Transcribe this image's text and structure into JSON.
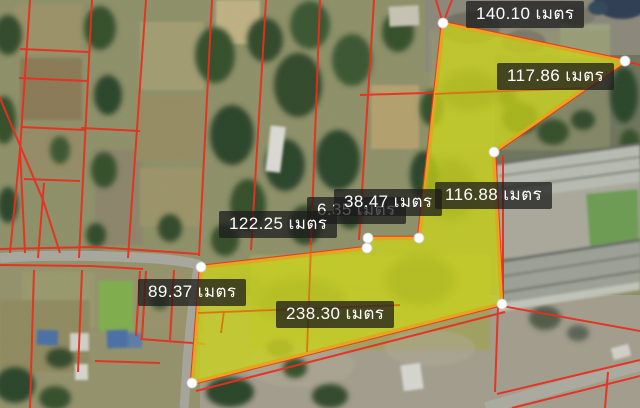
{
  "app": {
    "type": "satellite-map-land-measurement-tool",
    "language": "th",
    "unit_label": "เมตร"
  },
  "colors": {
    "parcel_fill": "#cbd318",
    "parcel_stroke": "#f0a01c",
    "cadastral_line": "#e92c1c",
    "vertex_handle": "#ffffff",
    "label_background": "rgba(28,28,28,0.75)",
    "label_text": "#ffffff"
  },
  "map": {
    "view": "satellite",
    "overlay": "cadastral-parcel-boundaries",
    "parcel": {
      "fill_color": "#cbd318",
      "stroke_color": "#f0a01c",
      "points": [
        [
          443,
          23
        ],
        [
          625,
          61
        ],
        [
          494,
          152
        ],
        [
          502,
          304
        ],
        [
          192,
          383
        ],
        [
          201,
          267
        ],
        [
          367,
          248
        ],
        [
          368,
          238
        ],
        [
          419,
          238
        ]
      ]
    },
    "measurements": [
      {
        "value": "140.10",
        "unit": "เมตร",
        "text": "140.10 เมตร"
      },
      {
        "value": "117.86",
        "unit": "เมตร",
        "text": "117.86 เมตร"
      },
      {
        "value": "116.88",
        "unit": "เมตร",
        "text": "116.88 เมตร"
      },
      {
        "value": "38.47",
        "unit": "เมตร",
        "text": "38.47 เมตร"
      },
      {
        "value": "6.35",
        "unit": "เมตร",
        "text": "6.35 เมตร"
      },
      {
        "value": "122.25",
        "unit": "เมตร",
        "text": "122.25 เมตร"
      },
      {
        "value": "89.37",
        "unit": "เมตร",
        "text": "89.37 เมตร"
      },
      {
        "value": "238.30",
        "unit": "เมตร",
        "text": "238.30 เมตร"
      }
    ]
  }
}
